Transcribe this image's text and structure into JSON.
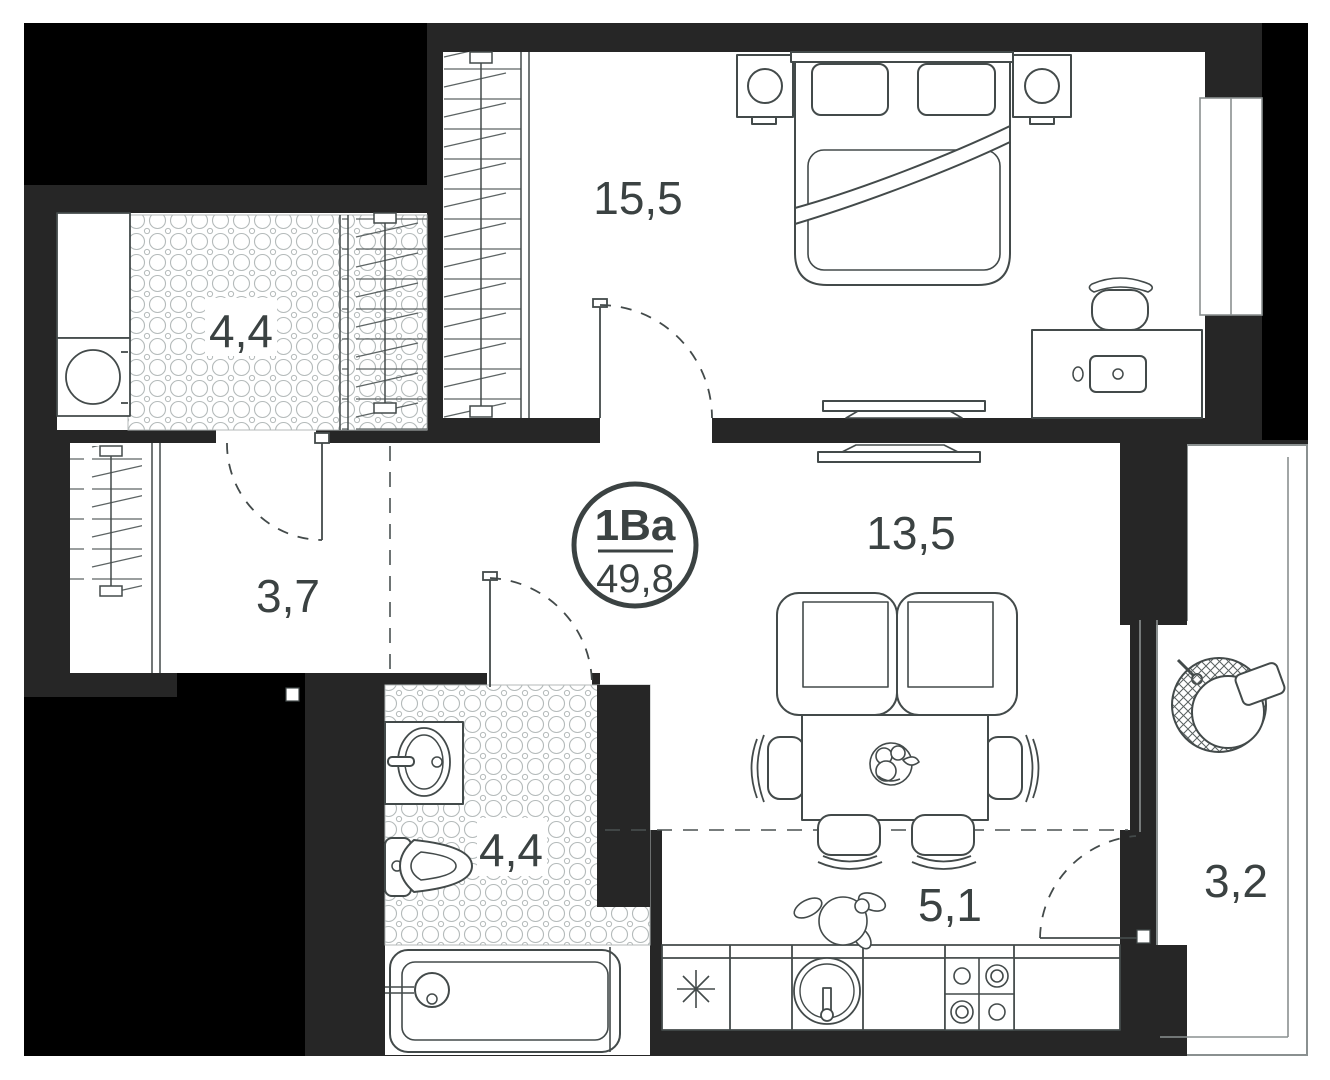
{
  "badge": {
    "unit_type": "1Ва",
    "total_area": "49,8"
  },
  "rooms": [
    {
      "name": "bedroom",
      "area": "15,5"
    },
    {
      "name": "loggia",
      "area": "4,4"
    },
    {
      "name": "hallway",
      "area": "3,7"
    },
    {
      "name": "living-room",
      "area": "13,5"
    },
    {
      "name": "bathroom",
      "area": "4,4"
    },
    {
      "name": "kitchen",
      "area": "5,1"
    },
    {
      "name": "balcony",
      "area": "3,2"
    }
  ],
  "furniture": {
    "bedroom": [
      "wardrobe",
      "double-bed",
      "nightstand-with-lamp",
      "nightstand-with-lamp",
      "desk",
      "desk-chair",
      "wall-tv"
    ],
    "living_room": [
      "wall-tv",
      "sofa",
      "dining-table",
      "dining-chairs",
      "fruit-bowl"
    ],
    "kitchen": [
      "fridge",
      "round-sink",
      "stove",
      "plant",
      "counter"
    ],
    "bathroom": [
      "sink",
      "toilet",
      "bathtub",
      "tiled-floor"
    ],
    "loggia": [
      "counter",
      "washing-machine",
      "wardrobe",
      "tiled-floor"
    ],
    "hallway": [
      "wardrobe"
    ],
    "balcony": [
      "hanging-chair"
    ]
  },
  "colors": {
    "background": "#ffffff",
    "wall": "#262626",
    "outside_void": "#000000",
    "floor": "#ffffff",
    "line": "#434a4a",
    "label_text": "#3b4242"
  }
}
